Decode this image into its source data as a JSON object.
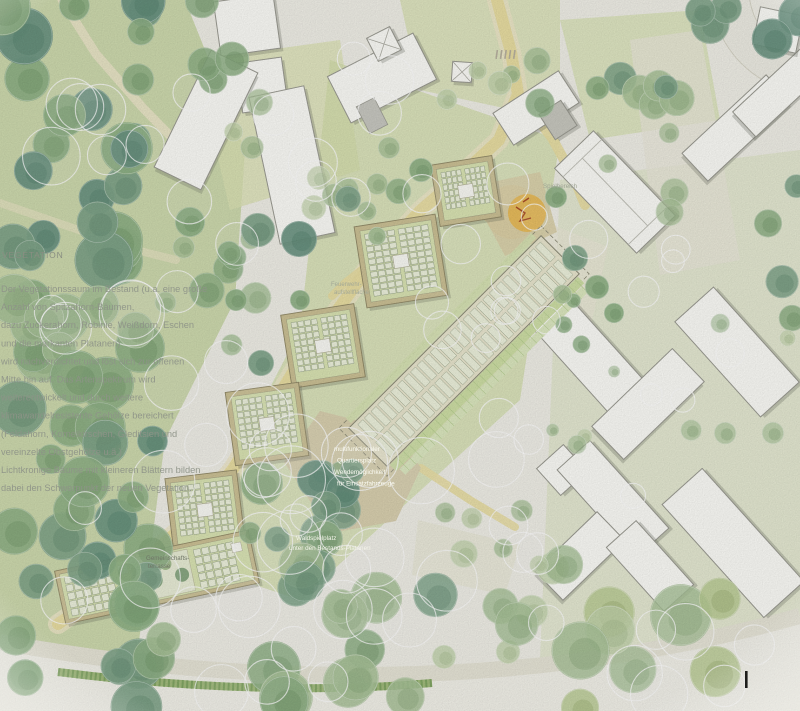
{
  "vegetation": {
    "title": "VEGETATION",
    "lines": [
      "Der Vegetationssaum im Bestand (u.a. eine große",
      "Anzahl von Spitzahorn-Bäumen,",
      "dazu Zuckerahorn, Robinie, Weißdorn, Eschen",
      "und die markanten Platanen)",
      "wird nachverdichtet und löst sich zur offenen",
      "Mitte hin auf. Das Artenspektrum wird",
      "weiterentwickelt und durch weitere",
      "klimawandelresistente Gehölze bereichert",
      "(Feldahorn, Kornelkirschen, Gleditsien und",
      "vereinzelte Obstgehölze u.ä.)",
      "Lichtkronige Bäume mit kleineren Blättern bilden",
      "dabei den Schwerpunkt der neuen Vegetation."
    ]
  },
  "labels": {
    "plaza_lines": [
      "multifunktionaler",
      "Quartiersplatz",
      "Wendemöglichkeit",
      "für Einsatzfahrzeuge"
    ],
    "fire_lines": [
      "Feuerwehr-",
      "aufstellfläche"
    ],
    "spielbereich": "Spielbereich",
    "wald_lines": [
      "Waldspielplatz",
      "unter den Bestands-Platanen"
    ],
    "terrace_lines": [
      "Gemeinschafts-",
      "terrasse"
    ]
  },
  "palette": {
    "paper": "#f1f0e8",
    "lawn_light": "#dde4b6",
    "lawn_mid": "#cdd9a0",
    "forest_wash": "#c9d7a4",
    "path_yellow": "#eadfa3",
    "plaza_tan": "#d9d0af",
    "tree_dark": "#6b9582",
    "tree_teal": "#7fa489",
    "tree_green": "#8fb286",
    "tree_sage": "#a9c399",
    "tree_pale": "#c3d4ad",
    "tree_yellowgreen": "#b9cc92",
    "building_white": "#fdfdf9",
    "building_outline": "#9b9b92",
    "new_wall": "#cdc296",
    "new_roof": "#dbe5b4",
    "pv_panel": "#eef2dd",
    "play_orange": "#eaba54",
    "text_gray": "#8e9388",
    "text_white": "#f6f6ec"
  }
}
